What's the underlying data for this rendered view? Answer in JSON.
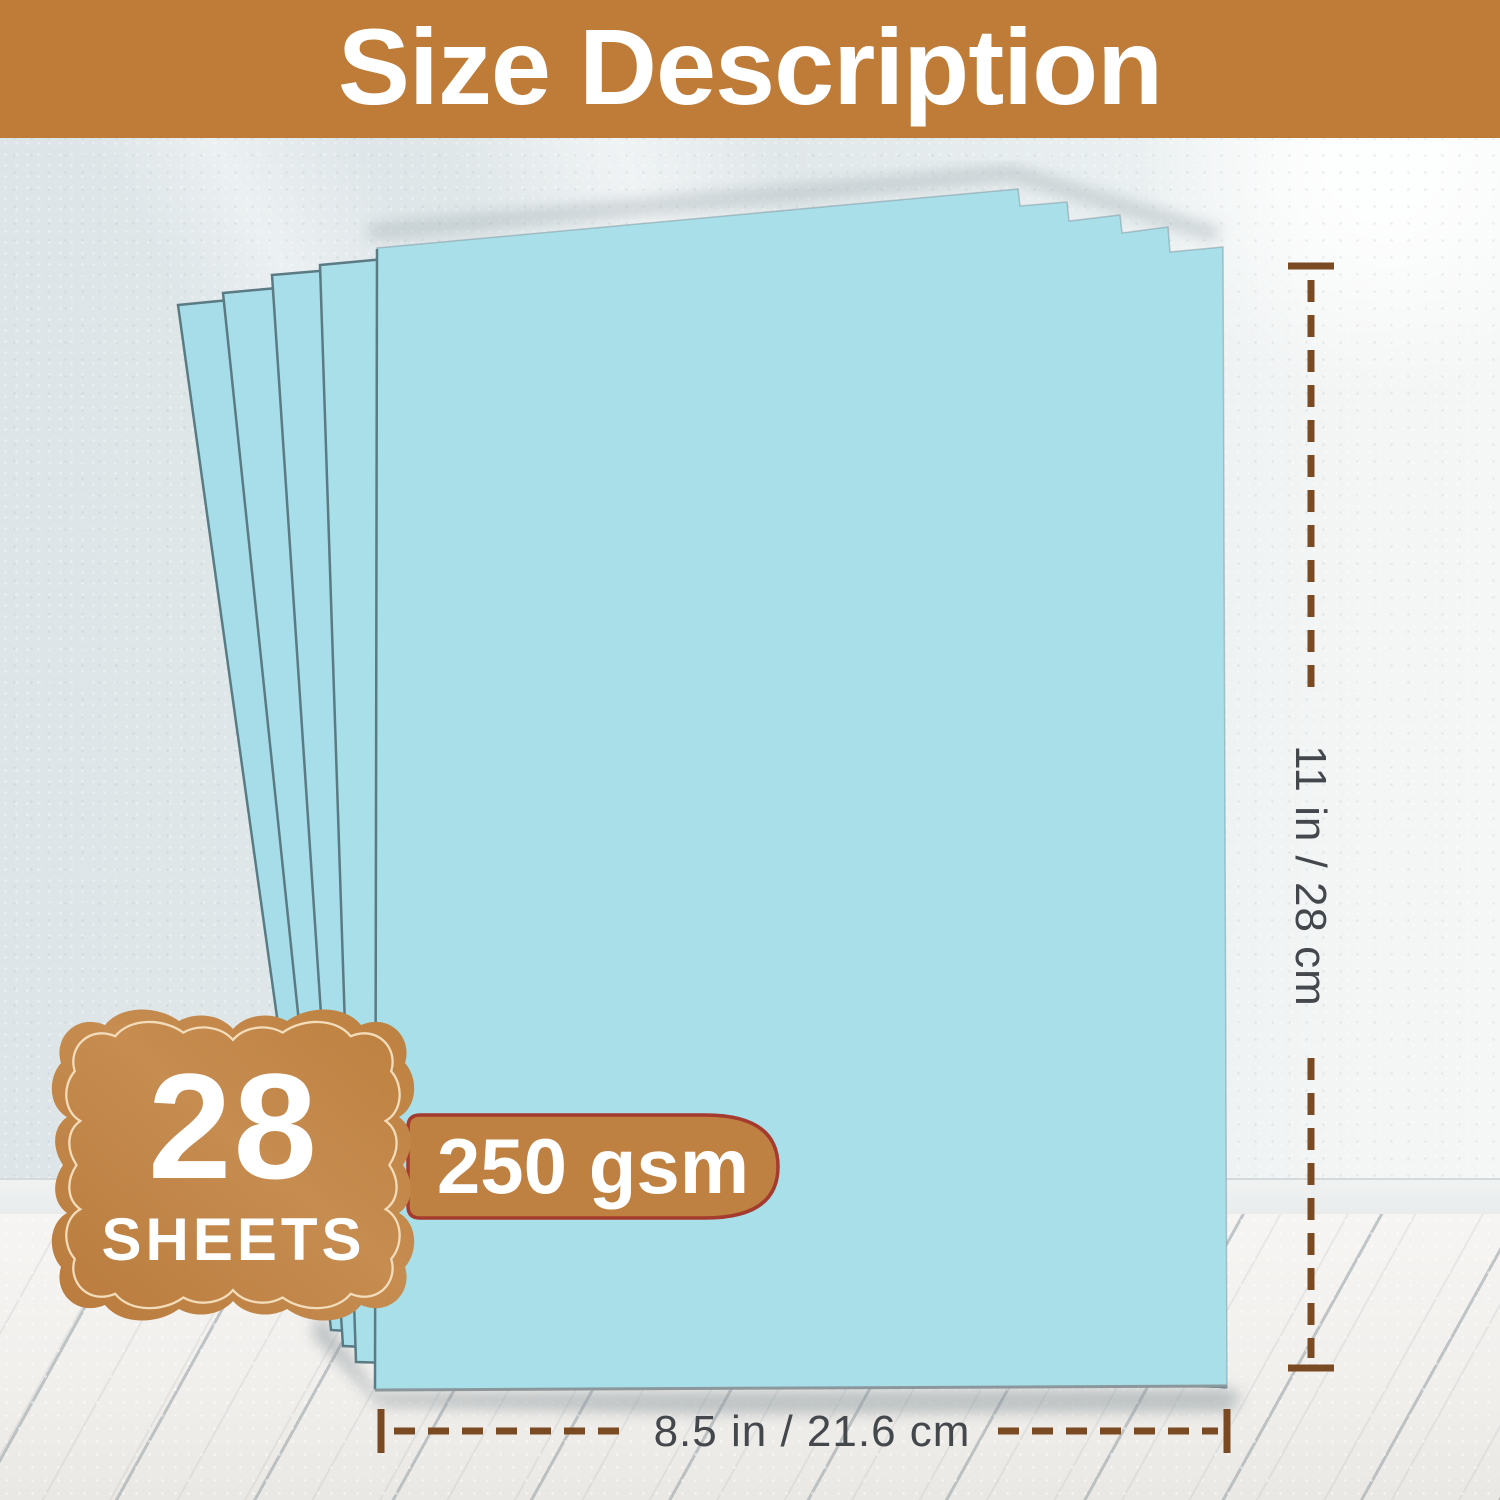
{
  "header": {
    "title": "Size Description"
  },
  "sheet_count_badge": {
    "count": "28",
    "unit": "SHEETS"
  },
  "weight_badge": {
    "label": "250 gsm"
  },
  "dimension_markers": {
    "height_label": "11 in / 28 cm",
    "width_label": "8.5 in / 21.6 cm"
  },
  "colors": {
    "banner_bg": "#be7c38",
    "badge_bg": "#c08548",
    "badge_inner_outline": "#f2dcba",
    "weight_pill_bg": "#bf8142",
    "weight_pill_border": "#a53a2e",
    "marker_line": "#7a4a22",
    "marker_text": "#44484d",
    "sheet_fill": "#a8dfe9",
    "sheet_edge": "#5a7a84",
    "wall_bg": "#e2e9eb",
    "floor_bg": "#f3f2ef"
  }
}
